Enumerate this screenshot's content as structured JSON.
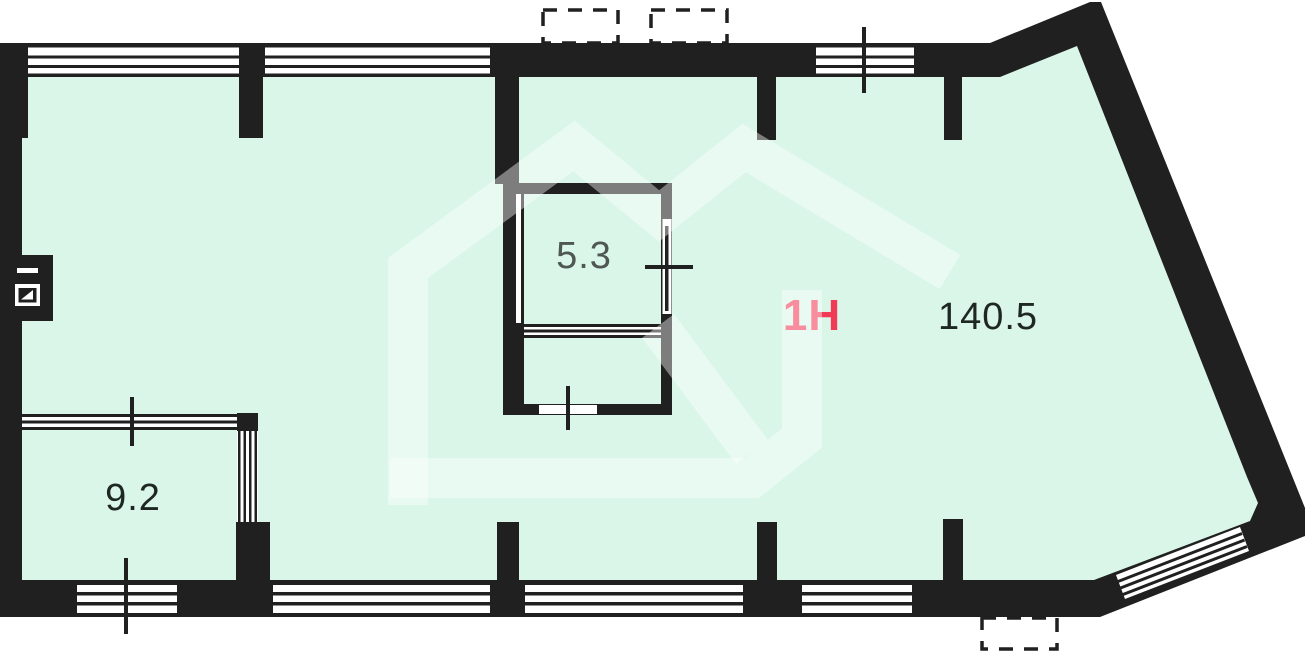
{
  "plan": {
    "type": "floor-plan",
    "unit": {
      "label": "1Н",
      "label_color": "#f13b56"
    },
    "rooms": [
      {
        "name": "main-hall",
        "area": "140.5"
      },
      {
        "name": "inner-storage",
        "area": "5.3"
      },
      {
        "name": "left-room",
        "area": "9.2"
      }
    ],
    "labels": {
      "unit": "1Н",
      "area_main": "140.5",
      "area_storage": "5.3",
      "area_left": "9.2"
    },
    "colors": {
      "floor": "#d9f6e8",
      "wall": "#1f201f",
      "window": "#ffffff",
      "accent": "#f13b56",
      "watermark": "rgba(255,255,255,0.42)",
      "background": "#ffffff"
    },
    "symbols": [
      "electric-panel-icon",
      "vent-shaft-dashed-box",
      "dimension-tick",
      "opening-cross-marker",
      "window-triple-line",
      "house-watermark"
    ]
  }
}
